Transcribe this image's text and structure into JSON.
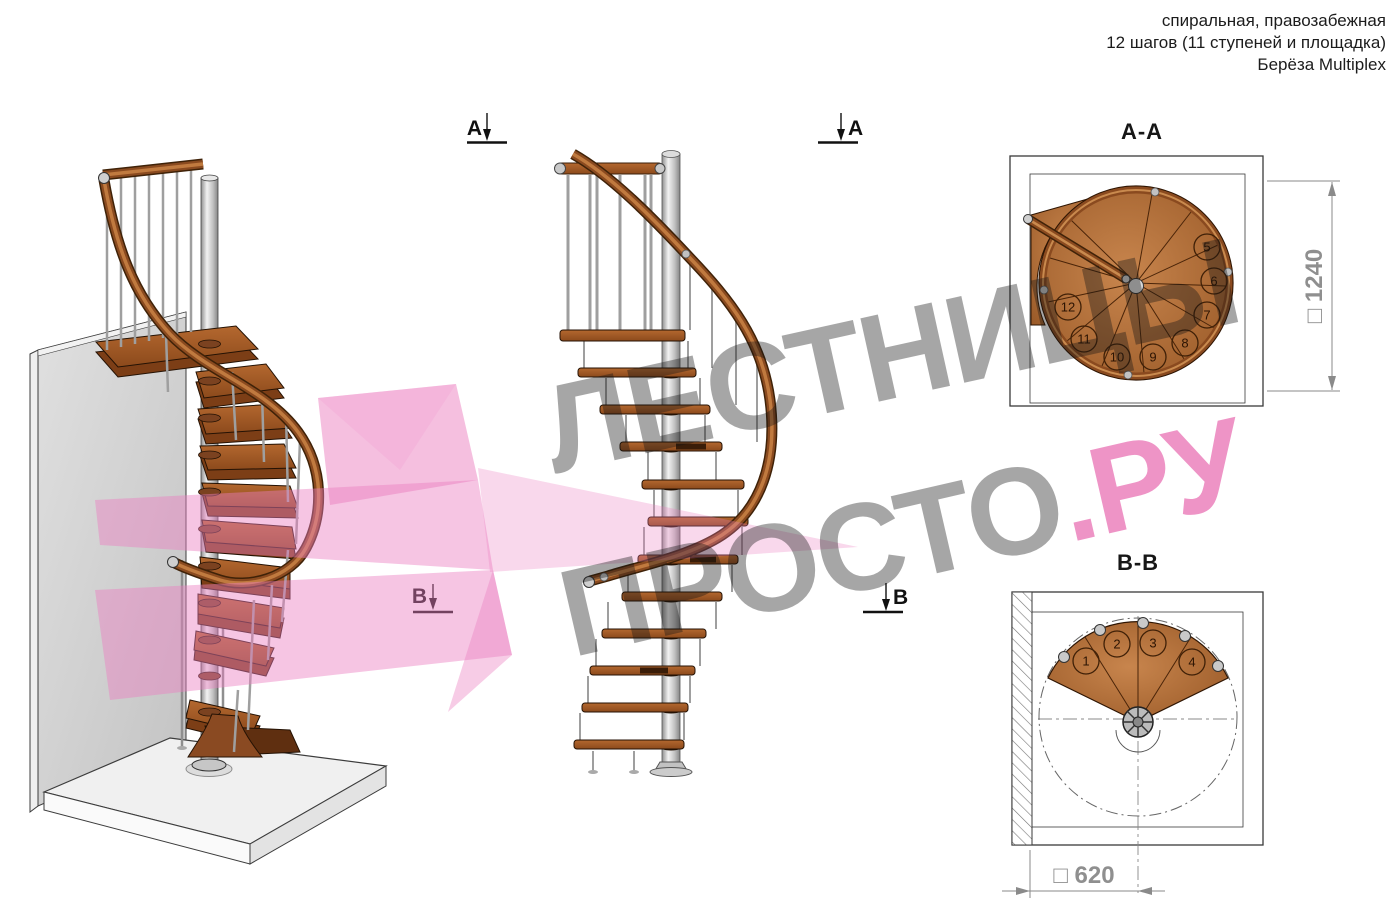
{
  "header": {
    "line1": "спиральная, правозабежная",
    "line2": "12 шагов (11 ступеней и площадка)",
    "line3": "Берёза Multiplex"
  },
  "section_markers": {
    "a": "А",
    "b": "В"
  },
  "views": {
    "aa": {
      "title": "А-А",
      "dimension": "□ 1240",
      "steps": [
        "5",
        "6",
        "7",
        "8",
        "9",
        "10",
        "11",
        "12"
      ]
    },
    "bb": {
      "title": "В-В",
      "dimension": "□ 620",
      "steps": [
        "1",
        "2",
        "3",
        "4"
      ]
    }
  },
  "watermark": {
    "line1": "ЛЕСТНИЦЫ",
    "line2_gray": "ПРОСТО",
    "line2_pink": ".РУ"
  },
  "colors": {
    "wood": "#a8602c",
    "wood_dark": "#6f3812",
    "rail_brown": "#8a4a1f",
    "pole_gray": "#c9c9c9",
    "wall_gray": "#d4d4d4",
    "logo_pink": "#e868ae",
    "watermark_gray": "#9e9e9e",
    "dimension_gray": "#8f8f8f",
    "line_black": "#2e2e2e"
  }
}
